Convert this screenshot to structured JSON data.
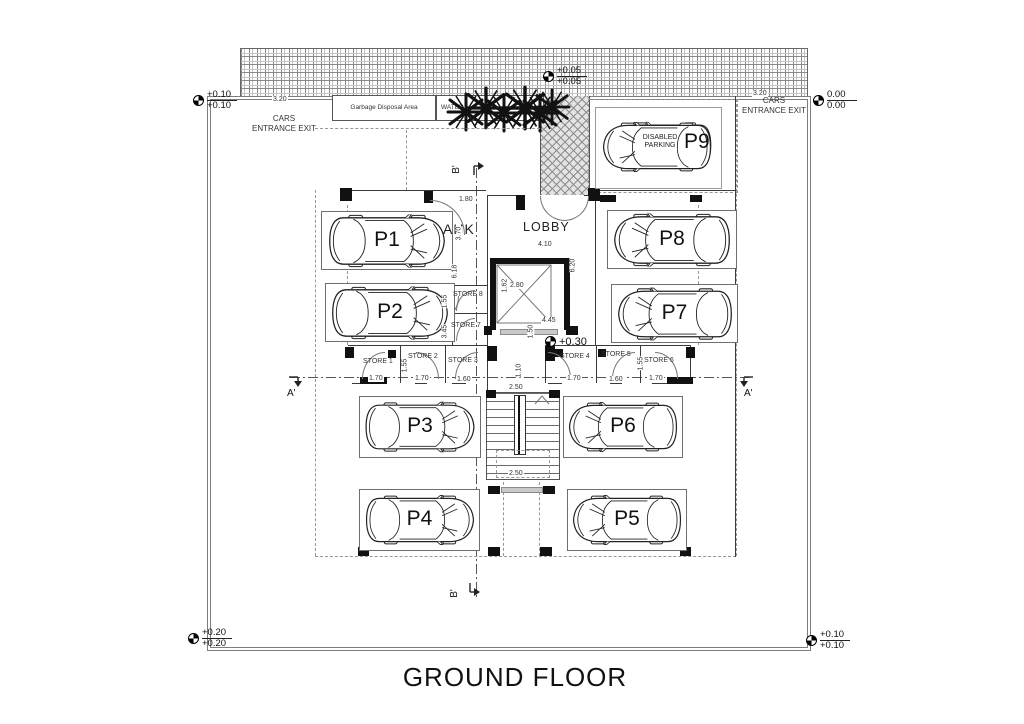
{
  "title": "GROUND FLOOR",
  "entrances": {
    "left": "CARS ENTRANCE EXIT",
    "right": "CARS ENTRANCE EXIT"
  },
  "service": {
    "garbage": "Garbage Disposal Area",
    "water": "WATER"
  },
  "rooms": {
    "ahk": "AHK",
    "lobby": "LOBBY"
  },
  "parking": {
    "p1": "P1",
    "p2": "P2",
    "p3": "P3",
    "p4": "P4",
    "p5": "P5",
    "p6": "P6",
    "p7": "P7",
    "p8": "P8",
    "p9": "P9",
    "disabled_note": "DISABLED PARKING"
  },
  "stores": [
    "STORE 1",
    "STORE 2",
    "STORE 3",
    "STORE 4",
    "STORE 5",
    "STORE 6",
    "STORE 7",
    "STORE 8"
  ],
  "levels": {
    "top_left": {
      "a": "+0.10",
      "b": "+0.10"
    },
    "top_center": {
      "a": "+0.05",
      "b": "+0.05"
    },
    "top_right": {
      "a": "0.00",
      "b": "0.00"
    },
    "center": {
      "a": "+0.30"
    },
    "bottom_left": {
      "a": "+0.20",
      "b": "+0.20"
    },
    "bottom_right": {
      "a": "+0.10",
      "b": "+0.10"
    }
  },
  "dims": {
    "site_left": "3.20",
    "site_right": "3.20",
    "ahk_w": "1.80",
    "ahk_h": "3.70",
    "col_h": "6.18",
    "store8_h": "1.55",
    "store7_h": "3.45",
    "lobby_w": "4.10",
    "lobby_h": "6.20",
    "elev_w": "2.80",
    "elev_h": "1.62",
    "hall_w": "4.45",
    "hall_h": "1.50",
    "corridor_w": "1.10",
    "stair_top": "2.50",
    "stair_bottom": "2.50",
    "s1": "1.70",
    "s2": "1.70",
    "s3": "1.60",
    "s4": "1.70",
    "s5": "1.60",
    "s6": "1.70",
    "side_l": "1.55",
    "side_r": "1.55"
  },
  "sections": {
    "a_left": "A'",
    "a_right": "A'",
    "b_top": "B'",
    "b_bottom": "B'"
  }
}
